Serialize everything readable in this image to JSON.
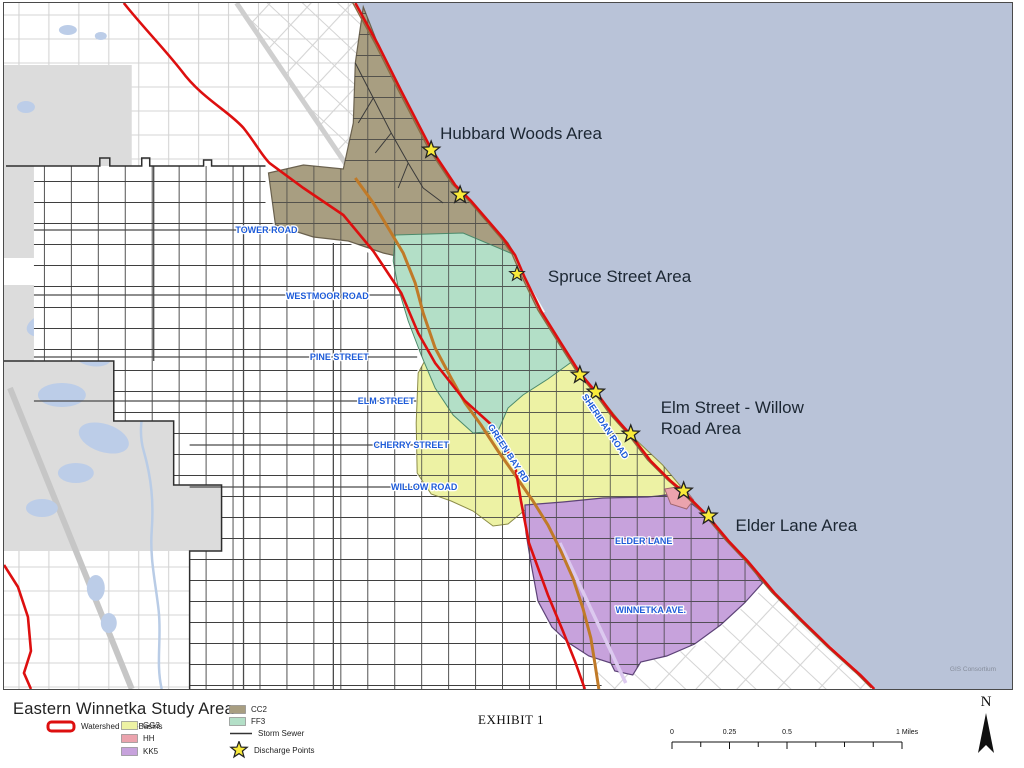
{
  "colors": {
    "watershed": "#dd0f0f",
    "lake": "#b9c3d8"
  },
  "map": {
    "areas": {
      "hubbard": "Hubbard Woods Area",
      "spruce": "Spruce Street Area",
      "elm_line1": "Elm Street - Willow",
      "elm_line2": "Road Area",
      "elder": "Elder Lane Area"
    },
    "streets": {
      "tower": "TOWER ROAD",
      "westmoor": "WESTMOOR ROAD",
      "pine": "PINE STREET",
      "elm": "ELM STREET",
      "cherry": "CHERRY STREET",
      "willow": "WILLOW ROAD",
      "greenbay": "GREEN BAY RD",
      "sheridan": "SHERIDAN ROAD",
      "elder_lane": "ELDER LANE",
      "winnetka": "WINNETKA AVE."
    },
    "credit": "GIS Consortium"
  },
  "legend": {
    "title": "Eastern Winnetka Study Area",
    "watershed_label": "Watershed Sub-Basins",
    "basins": [
      {
        "label": "GG3",
        "color": "#edf2a4"
      },
      {
        "label": "HH",
        "color": "#eba3ad"
      },
      {
        "label": "KK5",
        "color": "#c7a2dc"
      },
      {
        "label": "CC2",
        "color": "#a89e81"
      },
      {
        "label": "FF3",
        "color": "#b3dfc7"
      }
    ],
    "storm_sewer_label": "Storm Sewer",
    "discharge_label": "Discharge Points"
  },
  "footer": {
    "exhibit": "EXHIBIT 1",
    "north": "N",
    "scale": {
      "t0": "0",
      "t1": "0.25",
      "t2": "0.5",
      "t3": "1 Miles"
    }
  }
}
